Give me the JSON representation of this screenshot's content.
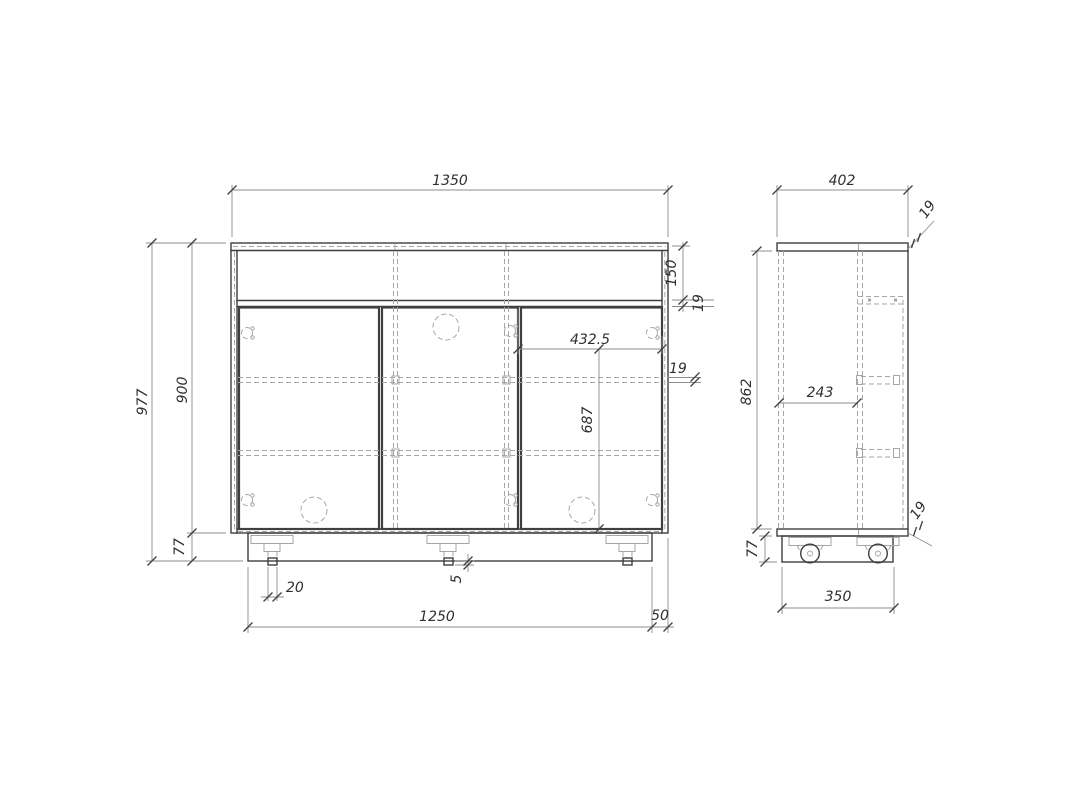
{
  "drawing": {
    "type": "furniture-orthographic-views",
    "views": [
      "front-view",
      "side-view"
    ]
  },
  "colors": {
    "bg": "#ffffff",
    "outline": "#3f3f3f",
    "hidden": "#a6a6a6",
    "dimline": "#8c8c8c",
    "dimtext": "#2f2f2f"
  },
  "dimensions": {
    "front": {
      "overall_width": "1350",
      "overall_height": "977",
      "body_height": "900",
      "plinth_height": "77",
      "drawer_front_height": "150",
      "rail_thickness": "19",
      "door_width": "432.5",
      "shelf_thickness": "19",
      "door_height": "687",
      "caster_stem_width": "20",
      "caster_protrusion": "5",
      "plinth_width": "1250",
      "plinth_inset": "50"
    },
    "side": {
      "overall_depth": "402",
      "top_panel_thickness": "19",
      "interior_height": "862",
      "partition_depth": "243",
      "bottom_panel_thickness": "19",
      "plinth_height": "77",
      "plinth_depth": "350"
    }
  }
}
